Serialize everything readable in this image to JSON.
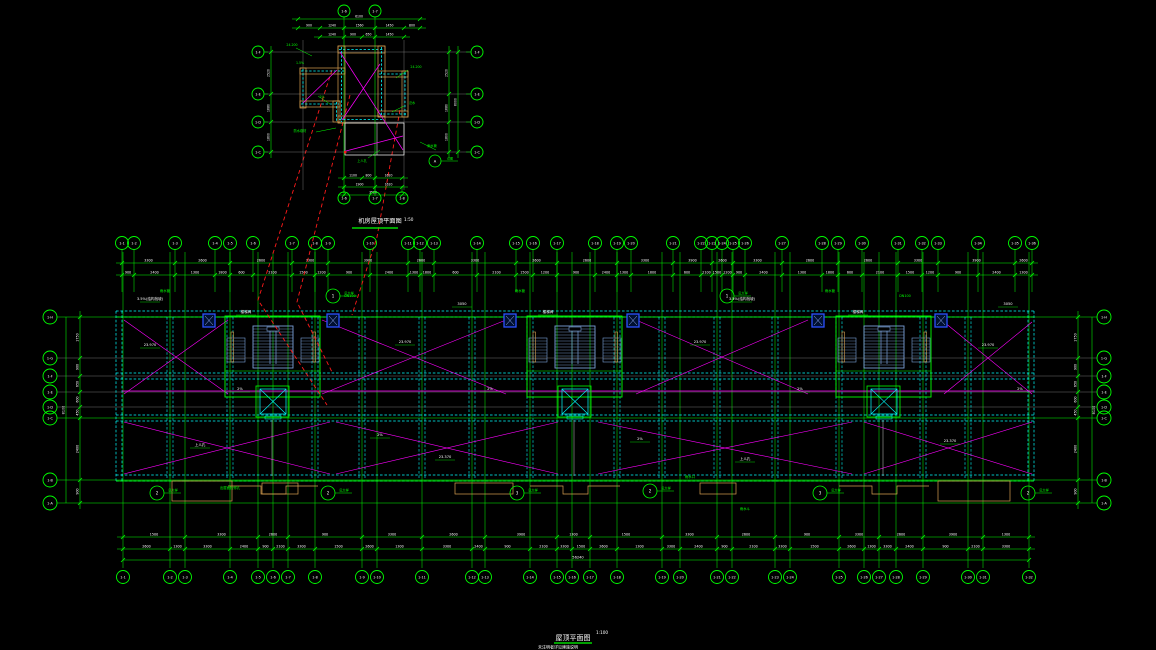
{
  "colors": {
    "bg": "#000000",
    "green": "#00ee00",
    "bright_green": "#00ff00",
    "cyan": "#00ffff",
    "magenta": "#ff00ff",
    "red": "#ff1a1a",
    "white": "#ffffff",
    "orange": "#d8a050",
    "stair_blue": "#7aa0d8",
    "box_blue": "#2b50ff",
    "gray": "#8c8c8c"
  },
  "titles": {
    "main": "屋顶平面图",
    "main_scale": "1:100",
    "note": "未注明者详见建施说明",
    "detail": "机房屋顶平面图",
    "detail_scale": "1:50"
  },
  "main": {
    "grid": {
      "top": {
        "y": 243,
        "x": [
          122,
          134,
          175,
          215,
          230,
          253,
          292,
          315,
          328,
          370,
          408,
          420,
          434,
          477,
          516,
          533,
          557,
          595,
          617,
          631,
          673,
          701,
          712,
          722,
          733,
          745,
          782,
          822,
          838,
          862,
          898,
          922,
          938,
          978,
          1015,
          1032
        ],
        "labels": [
          "1-1",
          "1-2",
          "1-3",
          "1-4",
          "1-5",
          "1-6",
          "1-7",
          "1-8",
          "1-9",
          "1-10",
          "1-11",
          "1-12",
          "1-13",
          "1-14",
          "1-15",
          "1-16",
          "1-17",
          "1-18",
          "1-19",
          "1-20",
          "1-21",
          "1-22",
          "1-23",
          "1-24",
          "1-25",
          "1-26",
          "1-27",
          "1-28",
          "1-29",
          "1-30",
          "1-31",
          "1-32",
          "1-33",
          "1-34",
          "1-35",
          "1-36"
        ]
      },
      "bottom": {
        "y": 577,
        "x": [
          123,
          170,
          185,
          230,
          258,
          273,
          288,
          315,
          362,
          377,
          422,
          472,
          485,
          530,
          557,
          572,
          590,
          617,
          662,
          680,
          717,
          732,
          775,
          790,
          839,
          864,
          879,
          896,
          923,
          968,
          983,
          1029
        ],
        "labels": [
          "1-1",
          "1-2",
          "1-3",
          "1-4",
          "1-5",
          "1-6",
          "1-7",
          "1-8",
          "1-9",
          "1-10",
          "1-11",
          "1-12",
          "1-13",
          "1-14",
          "1-15",
          "1-16",
          "1-17",
          "1-18",
          "1-19",
          "1-20",
          "1-21",
          "1-22",
          "1-23",
          "1-24",
          "1-25",
          "1-26",
          "1-27",
          "1-28",
          "1-29",
          "1-30",
          "1-31",
          "1-32"
        ]
      },
      "left": {
        "x": 50,
        "y": [
          317,
          358,
          376,
          392,
          407,
          418,
          480,
          503
        ],
        "labels": [
          "1-H",
          "1-G",
          "1-F",
          "1-E",
          "1-D",
          "1-C",
          "1-B",
          "1-A"
        ],
        "kinds": [
          "g",
          "x",
          "x",
          "x",
          "x",
          "g",
          "g",
          "g"
        ]
      },
      "right": {
        "x": 1104,
        "y": [
          317,
          358,
          376,
          392,
          407,
          418,
          480,
          503
        ],
        "labels": [
          "1-H",
          "1-G",
          "1-F",
          "1-E",
          "1-D",
          "1-C",
          "1-B",
          "1-A"
        ]
      }
    },
    "dims": {
      "top1": {
        "y": 263,
        "cycle": [
          "3300",
          "2600",
          "2600",
          "3300",
          "3900",
          "2600"
        ]
      },
      "top2": {
        "y": 275,
        "cycle": [
          "900",
          "2400",
          "1300",
          "1800",
          "600",
          "2100",
          "1500",
          "1200"
        ]
      },
      "bottom1": {
        "y": 537,
        "cycle": [
          "1500",
          "3300",
          "2600",
          "900",
          "3300",
          "2600",
          "3900",
          "1300"
        ]
      },
      "bottom2": {
        "y": 549,
        "cycle": [
          "2600",
          "1300",
          "3300",
          "2400",
          "900",
          "2100",
          "3300",
          "1500"
        ]
      },
      "overall": {
        "y": 560,
        "value": "56240"
      },
      "left_in": {
        "x": 80,
        "cycle": [
          "1750",
          "900",
          "650",
          "600",
          "450",
          "2400",
          "900"
        ]
      },
      "left_out": {
        "x": 66,
        "value": "8100"
      },
      "right_in": {
        "x": 1078,
        "cycle": [
          "1750",
          "900",
          "650",
          "600",
          "450",
          "2400",
          "900"
        ]
      },
      "right_out": {
        "x": 1092,
        "value": "8100"
      }
    },
    "walls": {
      "hbands": [
        311,
        373,
        415,
        475
      ],
      "outline": {
        "x1": 116,
        "x2": 1034,
        "y1": 311,
        "y2": 481
      },
      "interior_vx": [
        170,
        230,
        315,
        362,
        422,
        472,
        530,
        617,
        662,
        717,
        775,
        839,
        923,
        968
      ]
    },
    "stair_cores": [
      273,
      575,
      884
    ],
    "blue_boxes": [
      203,
      327,
      504,
      627,
      812,
      935
    ],
    "magenta": {
      "ridge": [
        122,
        391,
        1034,
        391
      ],
      "panels_top": [
        [
          124,
          320,
          228,
          394
        ],
        [
          322,
          320,
          506,
          394
        ],
        [
          636,
          320,
          808,
          394
        ],
        [
          944,
          322,
          1032,
          394
        ]
      ],
      "panels_bottom": [
        [
          124,
          422,
          330,
          474
        ],
        [
          336,
          422,
          558,
          474
        ],
        [
          598,
          422,
          852,
          474
        ],
        [
          864,
          422,
          1032,
          474
        ]
      ]
    },
    "tan_rects": [
      [
        172,
        481,
        60,
        20
      ],
      [
        262,
        483,
        36,
        11
      ],
      [
        455,
        483,
        58,
        11
      ],
      [
        700,
        483,
        36,
        11
      ],
      [
        938,
        481,
        72,
        20
      ]
    ],
    "red_leaders": [
      [
        332,
        70,
        258,
        300,
        327,
        405
      ],
      [
        350,
        95,
        297,
        302,
        332,
        372
      ],
      [
        400,
        110,
        377,
        237,
        352,
        315
      ]
    ],
    "callouts": [
      [
        333,
        296,
        "1"
      ],
      [
        727,
        296,
        "1"
      ],
      [
        157,
        493,
        "2"
      ],
      [
        328,
        493,
        "2"
      ],
      [
        517,
        493,
        "3"
      ],
      [
        650,
        491,
        "2"
      ],
      [
        820,
        493,
        "3"
      ],
      [
        1028,
        493,
        "2"
      ]
    ],
    "callout_note": "见大样",
    "white_labels": [
      [
        150,
        300,
        "3.5%(结构找坡)"
      ],
      [
        462,
        305,
        "3050"
      ],
      [
        742,
        300,
        "3.5%(结构找坡)"
      ],
      [
        1008,
        305,
        "3050"
      ],
      [
        150,
        346,
        "23.970"
      ],
      [
        405,
        343,
        "23.970"
      ],
      [
        700,
        343,
        "23.970"
      ],
      [
        988,
        346,
        "23.970"
      ],
      [
        240,
        390,
        "2%"
      ],
      [
        490,
        390,
        "2%"
      ],
      [
        800,
        390,
        "2%"
      ],
      [
        1020,
        390,
        "2%"
      ],
      [
        246,
        313,
        "楼梯间"
      ],
      [
        548,
        313,
        "楼梯间"
      ],
      [
        858,
        313,
        "楼梯间"
      ],
      [
        200,
        446,
        "上人孔"
      ],
      [
        380,
        436,
        "2%"
      ],
      [
        445,
        458,
        "23.370"
      ],
      [
        640,
        440,
        "2%"
      ],
      [
        745,
        460,
        "上人孔"
      ],
      [
        950,
        442,
        "23.370"
      ]
    ],
    "green_labels": [
      [
        165,
        292,
        "雨水管"
      ],
      [
        520,
        292,
        "雨水管"
      ],
      [
        830,
        292,
        "雨水管"
      ],
      [
        350,
        297,
        "DN100"
      ],
      [
        905,
        297,
        "DN100"
      ],
      [
        690,
        478,
        "雨水口"
      ],
      [
        230,
        489,
        "出屋面检修孔"
      ],
      [
        745,
        510,
        "雨水斗"
      ]
    ]
  },
  "detail": {
    "bubbles": {
      "top": {
        "y": 11,
        "x": [
          344,
          375
        ],
        "labels": [
          "1-6",
          "1-7"
        ]
      },
      "bottom": {
        "y": 198,
        "x": [
          344,
          375,
          402
        ],
        "labels": [
          "1-6",
          "1-7",
          "1-8"
        ]
      },
      "left": {
        "x": 258,
        "y": [
          52,
          94,
          122,
          152
        ],
        "labels": [
          "1-F",
          "1-E",
          "1-D",
          "1-C"
        ]
      },
      "right": {
        "x": 477,
        "y": [
          52,
          94,
          122,
          152
        ],
        "labels": [
          "1-F",
          "1-E",
          "1-D",
          "1-C"
        ]
      }
    },
    "dims": {
      "top_over": {
        "y": 19,
        "ticks": [
          298,
          420
        ],
        "values": [
          "6100"
        ]
      },
      "top1": {
        "y": 28,
        "ticks": [
          298,
          320,
          344,
          375,
          404,
          420
        ],
        "values": [
          "900",
          "1240",
          "1560",
          "1450",
          "800"
        ]
      },
      "top2": {
        "y": 37,
        "ticks": [
          320,
          344,
          362,
          375,
          404
        ],
        "values": [
          "1240",
          "900",
          "650",
          "1450"
        ]
      },
      "bottom1": {
        "y": 178,
        "ticks": [
          344,
          362,
          375,
          402
        ],
        "values": [
          "1100",
          "800",
          "1620"
        ]
      },
      "bottom2": {
        "y": 187,
        "ticks": [
          344,
          375,
          402
        ],
        "values": [
          "1900",
          "1620"
        ]
      },
      "bottom_over": {
        "y": 195,
        "ticks": [
          344,
          402
        ],
        "values": [
          "3520"
        ]
      },
      "left1": {
        "x": 271,
        "ticks": [
          52,
          94,
          122,
          152
        ],
        "values": [
          "2520",
          "1680",
          "1800"
        ]
      },
      "right1": {
        "x": 449,
        "ticks": [
          52,
          94,
          122,
          152
        ],
        "values": [
          "2520",
          "1680",
          "1800"
        ]
      },
      "right2": {
        "x": 458,
        "ticks": [
          52,
          152
        ],
        "values": [
          "6000"
        ]
      }
    },
    "bands": [
      [
        338,
        46,
        47,
        7
      ],
      [
        378,
        46,
        7,
        71
      ],
      [
        378,
        71,
        30,
        6
      ],
      [
        402,
        71,
        6,
        46
      ],
      [
        378,
        111,
        30,
        6
      ],
      [
        338,
        46,
        7,
        77
      ],
      [
        300,
        68,
        45,
        6
      ],
      [
        300,
        68,
        6,
        40
      ],
      [
        300,
        101,
        40,
        6
      ],
      [
        333,
        101,
        7,
        21
      ],
      [
        338,
        116,
        47,
        7
      ]
    ],
    "white_rect": [
      345,
      123,
      59,
      32
    ],
    "gray_h": [
      [
        265,
        52,
        470,
        52
      ],
      [
        265,
        94,
        470,
        94
      ],
      [
        265,
        122,
        470,
        122
      ],
      [
        265,
        152,
        470,
        152
      ]
    ],
    "gray_v": [
      [
        303,
        40,
        303,
        190
      ],
      [
        404,
        40,
        404,
        190
      ]
    ],
    "green_v": [
      [
        344,
        26,
        344,
        196
      ],
      [
        375,
        26,
        375,
        196
      ]
    ],
    "magenta": [
      [
        340,
        52,
        403,
        150
      ],
      [
        380,
        64,
        342,
        120
      ],
      [
        303,
        103,
        337,
        70
      ],
      [
        346,
        151,
        403,
        136
      ]
    ],
    "leaders": [
      [
        296,
        48,
        312,
        56
      ],
      [
        318,
        96,
        330,
        104
      ],
      [
        408,
        70,
        396,
        78
      ],
      [
        404,
        106,
        392,
        112
      ],
      [
        316,
        132,
        336,
        128
      ],
      [
        368,
        158,
        380,
        150
      ],
      [
        436,
        150,
        420,
        142
      ]
    ],
    "green_texts": [
      [
        292,
        46,
        "24.200"
      ],
      [
        300,
        64,
        "1.5%"
      ],
      [
        416,
        68,
        "24.200"
      ],
      [
        322,
        98,
        "2%"
      ],
      [
        412,
        104,
        "泛水"
      ],
      [
        300,
        132,
        "防水卷材"
      ],
      [
        362,
        162,
        "上人孔"
      ],
      [
        432,
        147,
        "雨水管"
      ]
    ],
    "callout": {
      "x": 435,
      "y": 161,
      "label": "A",
      "note": "详图"
    },
    "red_dot": [
      344,
      151
    ]
  }
}
